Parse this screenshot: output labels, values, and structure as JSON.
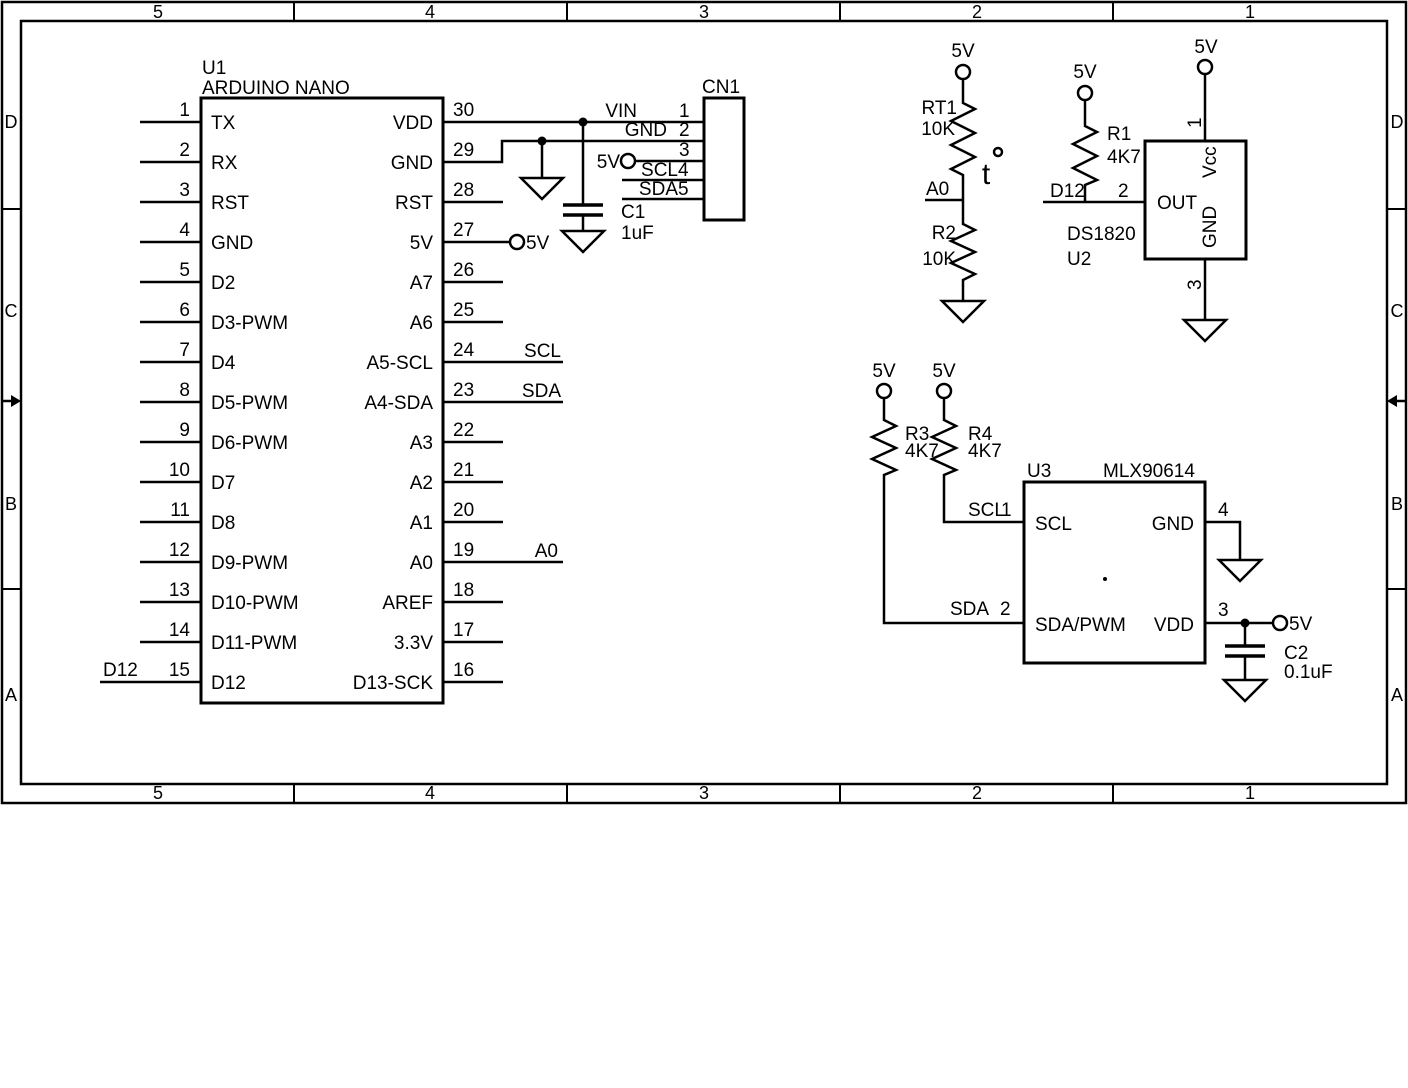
{
  "frame": {
    "cols": [
      "5",
      "4",
      "3",
      "2",
      "1"
    ],
    "rows": [
      "D",
      "C",
      "B",
      "A"
    ]
  },
  "nets": {
    "v5": "5V",
    "vin": "VIN",
    "gnd": "GND",
    "scl": "SCL",
    "sda": "SDA",
    "a0": "A0",
    "d12": "D12"
  },
  "u1": {
    "ref": "U1",
    "name": "ARDUINO NANO",
    "left_pins": [
      {
        "num": "1",
        "label": "TX"
      },
      {
        "num": "2",
        "label": "RX"
      },
      {
        "num": "3",
        "label": "RST"
      },
      {
        "num": "4",
        "label": "GND"
      },
      {
        "num": "5",
        "label": "D2"
      },
      {
        "num": "6",
        "label": "D3-PWM"
      },
      {
        "num": "7",
        "label": "D4"
      },
      {
        "num": "8",
        "label": "D5-PWM"
      },
      {
        "num": "9",
        "label": "D6-PWM"
      },
      {
        "num": "10",
        "label": "D7"
      },
      {
        "num": "11",
        "label": "D8"
      },
      {
        "num": "12",
        "label": "D9-PWM"
      },
      {
        "num": "13",
        "label": "D10-PWM"
      },
      {
        "num": "14",
        "label": "D11-PWM"
      },
      {
        "num": "15",
        "label": "D12"
      }
    ],
    "right_pins": [
      {
        "num": "30",
        "label": "VDD"
      },
      {
        "num": "29",
        "label": "GND"
      },
      {
        "num": "28",
        "label": "RST"
      },
      {
        "num": "27",
        "label": "5V"
      },
      {
        "num": "26",
        "label": "A7"
      },
      {
        "num": "25",
        "label": "A6"
      },
      {
        "num": "24",
        "label": "A5-SCL"
      },
      {
        "num": "23",
        "label": "A4-SDA"
      },
      {
        "num": "22",
        "label": "A3"
      },
      {
        "num": "21",
        "label": "A2"
      },
      {
        "num": "20",
        "label": "A1"
      },
      {
        "num": "19",
        "label": "A0"
      },
      {
        "num": "18",
        "label": "AREF"
      },
      {
        "num": "17",
        "label": "3.3V"
      },
      {
        "num": "16",
        "label": "D13-SCK"
      }
    ]
  },
  "cn1": {
    "ref": "CN1",
    "pin_numbers": [
      "1",
      "2",
      "3",
      "4",
      "5"
    ]
  },
  "u2": {
    "ref": "U2",
    "name": "DS1820",
    "pins": {
      "vcc": {
        "num": "1",
        "label": "Vcc"
      },
      "out": {
        "num": "2",
        "label": "OUT"
      },
      "gnd": {
        "num": "3",
        "label": "GND"
      }
    }
  },
  "u3": {
    "ref": "U3",
    "name": "MLX90614",
    "pins": {
      "scl": {
        "num": "1",
        "label": "SCL"
      },
      "sda": {
        "num": "2",
        "label": "SDA/PWM"
      },
      "vdd": {
        "num": "3",
        "label": "VDD"
      },
      "gnd": {
        "num": "4",
        "label": "GND"
      }
    }
  },
  "resistors": {
    "rt1": {
      "ref": "RT1",
      "value": "10K"
    },
    "r1": {
      "ref": "R1",
      "value": "4K7"
    },
    "r2": {
      "ref": "R2",
      "value": "10K"
    },
    "r3": {
      "ref": "R3",
      "value": "4K7"
    },
    "r4": {
      "ref": "R4",
      "value": "4K7"
    }
  },
  "capacitors": {
    "c1": {
      "ref": "C1",
      "value": "1uF"
    },
    "c2": {
      "ref": "C2",
      "value": "0.1uF"
    }
  },
  "thermistor_mark": "t"
}
